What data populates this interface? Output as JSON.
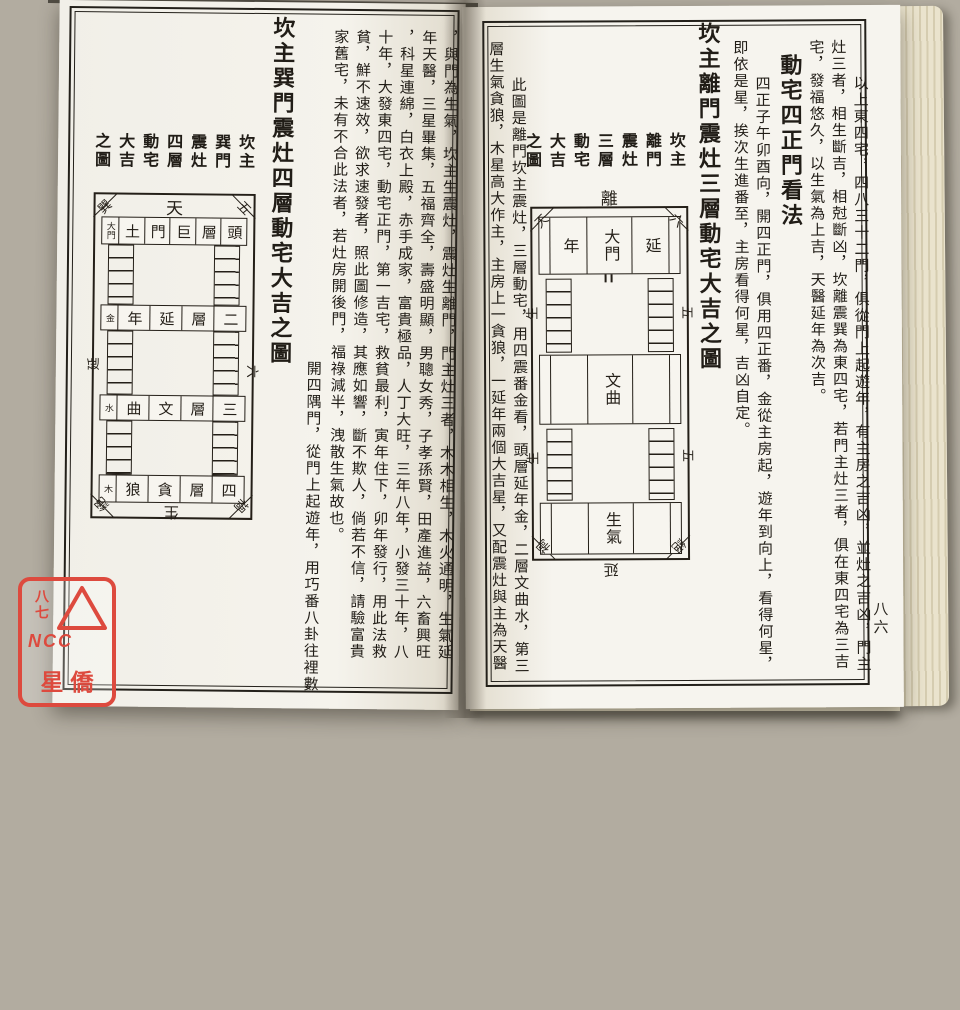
{
  "left_page": {
    "text_columns": [
      "，與門為生氣，坎主生震灶，震灶生離門，門主灶三者，木木相生，木火通明，生氣延",
      "年天醫，三星畢集，五福齊全，壽盛明顯，男聰女秀，子孝孫賢，田產進益，六畜興旺",
      "，科星連綿，白衣上殿，赤手成家，富貴極品，人丁大旺，三年八年，小發三十年，八",
      "十年，大發東四宅，動宅正門，第一吉宅，救貧最利，寅年住下，卯年發行，用此法救",
      "貧，鮮不速效，欲求速發者，照此圖修造，其應如響，斷不欺人，倘若不信，請驗富貴",
      "家舊宅，未有不合此法者，若灶房開後門，福祿減半，洩散生氣故也。"
    ],
    "note_column": "開四隅門，從門上起遊年，用巧番八卦往裡數",
    "diagram_title": "坎主巽門震灶四層動宅大吉之圖",
    "diagram_labels": [
      "坎主",
      "巽門",
      "震灶",
      "四層",
      "動宅",
      "大吉",
      "之圖"
    ],
    "diagram": {
      "direction_top": "天",
      "corner_top_left": "巽",
      "corner_top_right": "五",
      "corner_bottom_left": "絕",
      "corner_bottom_right": "禍",
      "side_left": "延",
      "side_right": "六",
      "direction_bottom": "生",
      "layer_rows": [
        [
          "大門",
          "土",
          "門",
          "巨",
          "層",
          "頭"
        ],
        [
          "金",
          "年",
          "延",
          "層",
          "二"
        ],
        [
          "水",
          "曲",
          "文",
          "層",
          "三"
        ],
        [
          "木",
          "狼",
          "貪",
          "層",
          "四"
        ]
      ]
    }
  },
  "right_page": {
    "page_number": "八六",
    "intro_columns": [
      "以上東四宅，四八三十二門，俱從門上起遊年，有主房之吉凶，並灶之吉凶，門主",
      "灶三者，相生斷吉，相尅斷凶，坎離震巽為東四宅，若門主灶三者，俱在東四宅為三吉",
      "宅，發福悠久，以生氣為上吉，天醫延年為次吉。"
    ],
    "section_heading": "動宅四正門看法",
    "method_columns": [
      "四正子午卯酉向，開四正門，俱用四正番，金從主房起，遊年到向上，看得何星，",
      "即依是星，挨次生進番至，主房看得何星，吉凶自定。"
    ],
    "diagram_title": "坎主離門震灶三層動宅大吉之圖",
    "diagram_labels": [
      "坎主",
      "離門",
      "震灶",
      "三層",
      "動宅",
      "大吉",
      "之圖"
    ],
    "note_columns": [
      "此圖是離門坎主震灶，三層動宅，用四震番金看，頭層延年金，二層文曲水，第三",
      "層生氣貪狼，木星高大作主，主房上一貪狼，一延年兩個大吉星，又配震灶與主為天醫"
    ],
    "diagram": {
      "direction_top": "離",
      "corner_top_left": "天",
      "corner_top_right": "六",
      "corner_bottom_left": "禍",
      "corner_bottom_right": "絕",
      "side_left": [
        "生",
        "生"
      ],
      "side_right": [
        "五",
        "五"
      ],
      "direction_bottom": "延",
      "layer1_cells": [
        "年",
        "大門",
        "延"
      ],
      "layer2_room": "文曲",
      "layer3_room": "生氣"
    }
  },
  "stamp": {
    "page_number": "八七",
    "ncc": "NCC",
    "brand": "星僑"
  },
  "colors": {
    "stamp_red": "#dd4a3e",
    "ink": "#211d17",
    "paper": "#f5f3ec"
  }
}
